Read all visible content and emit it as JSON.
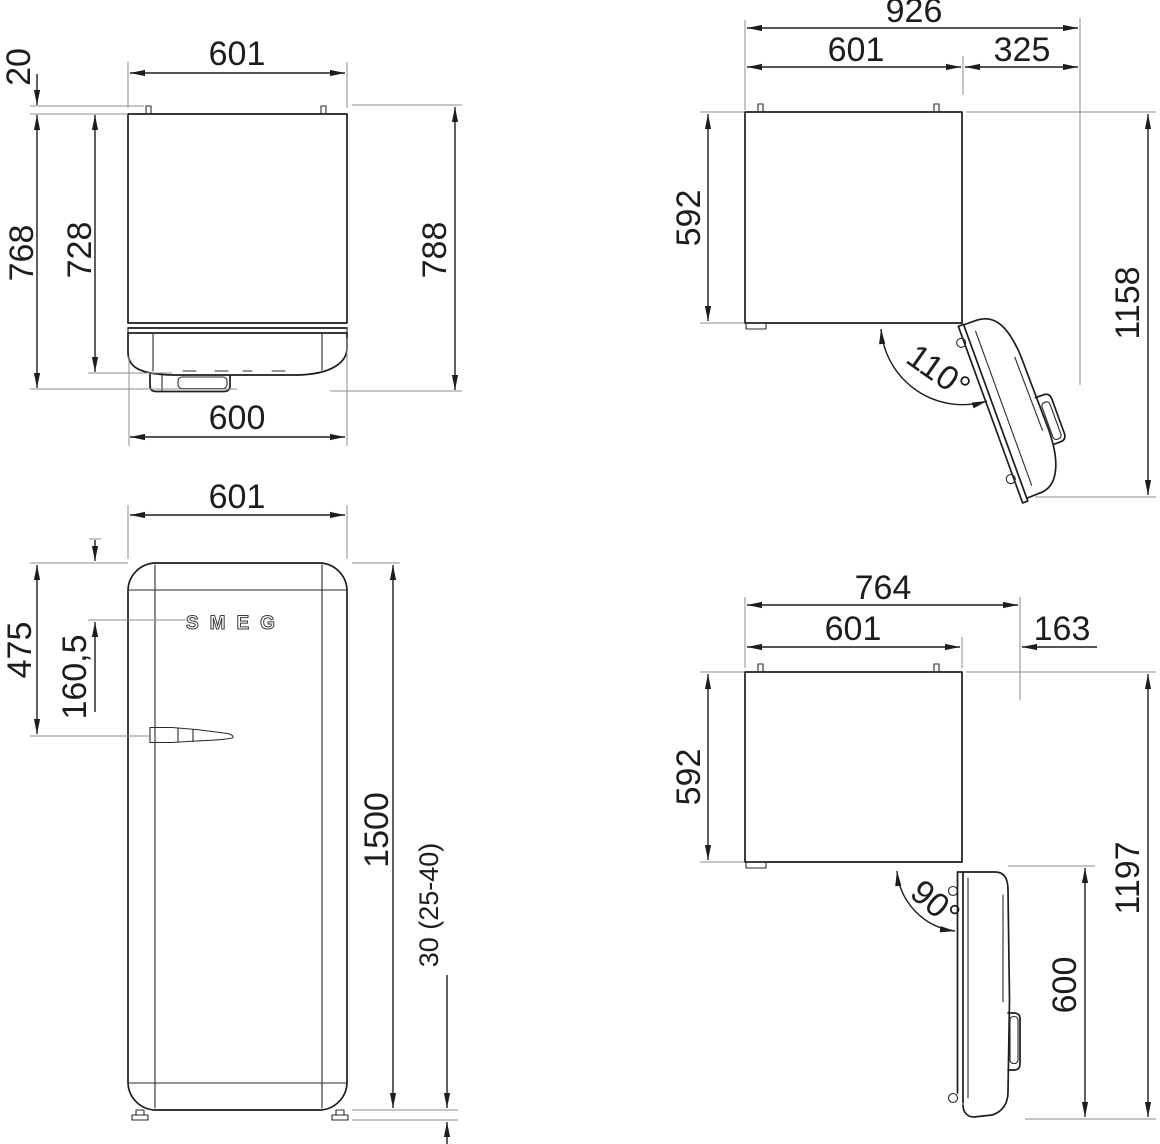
{
  "logo": "SMEG",
  "colors": {
    "line": "#1d1d1b",
    "extension": "#8c8c8c",
    "background": "#ffffff"
  },
  "views": {
    "plan_closed": {
      "dims": {
        "width": "601",
        "hinge_pin": "20",
        "depth_with_door": "728",
        "depth_with_handle": "768",
        "depth_total": "788",
        "door_width": "600"
      }
    },
    "plan_open_110": {
      "dims": {
        "envelope_width": "926",
        "width": "601",
        "door_projection": "325",
        "body_depth": "592",
        "envelope_depth": "1158",
        "angle": "110°"
      }
    },
    "front": {
      "dims": {
        "width": "601",
        "handle_from_top": "475",
        "logo_from_top": "160,5",
        "height": "1500",
        "feet": "30 (25-40)"
      }
    },
    "plan_open_90": {
      "dims": {
        "envelope_width": "764",
        "width": "601",
        "door_projection": "163",
        "body_depth": "592",
        "envelope_depth": "1197",
        "door_depth": "600",
        "angle": "90°"
      }
    }
  }
}
